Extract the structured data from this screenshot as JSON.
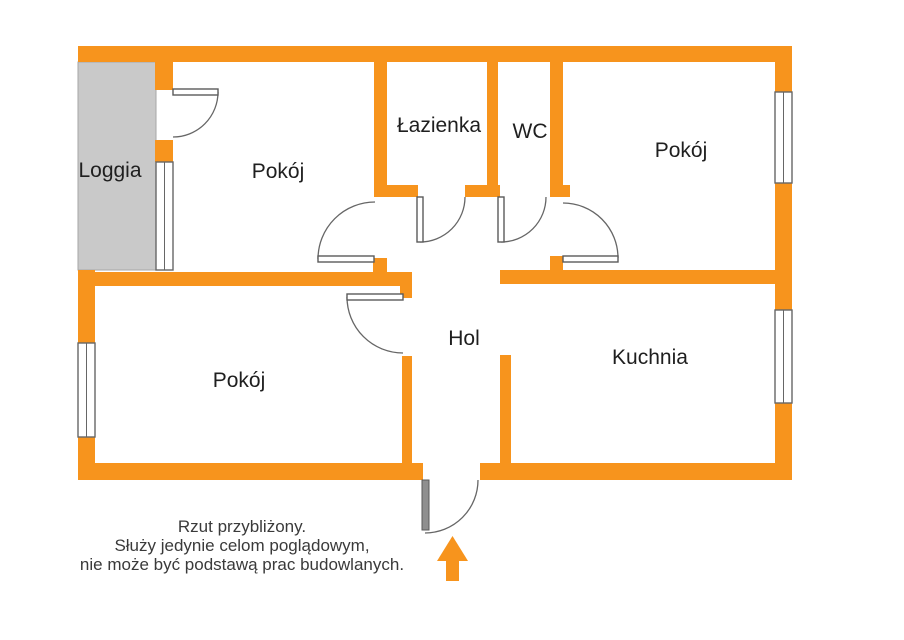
{
  "plan": {
    "type": "apartment-floor-plan",
    "rooms": [
      {
        "id": "loggia",
        "label": "Loggia"
      },
      {
        "id": "room-top-left",
        "label": "Pokój"
      },
      {
        "id": "bathroom",
        "label": "Łazienka"
      },
      {
        "id": "wc",
        "label": "WC"
      },
      {
        "id": "room-top-right",
        "label": "Pokój"
      },
      {
        "id": "room-bottom",
        "label": "Pokój"
      },
      {
        "id": "hall",
        "label": "Hol"
      },
      {
        "id": "kitchen",
        "label": "Kuchnia"
      }
    ]
  },
  "caption": {
    "line1": "Rzut przybliżony.",
    "line2": "Służy jedynie celom poglądowym,",
    "line3": "nie może być podstawą prac budowlanych."
  },
  "colors": {
    "wall": "#F7941D",
    "loggia_fill": "#C9C9C9",
    "outline": "#666666",
    "text": "#3a3a3a"
  },
  "icons": {
    "entrance_arrow": "arrow-up"
  }
}
